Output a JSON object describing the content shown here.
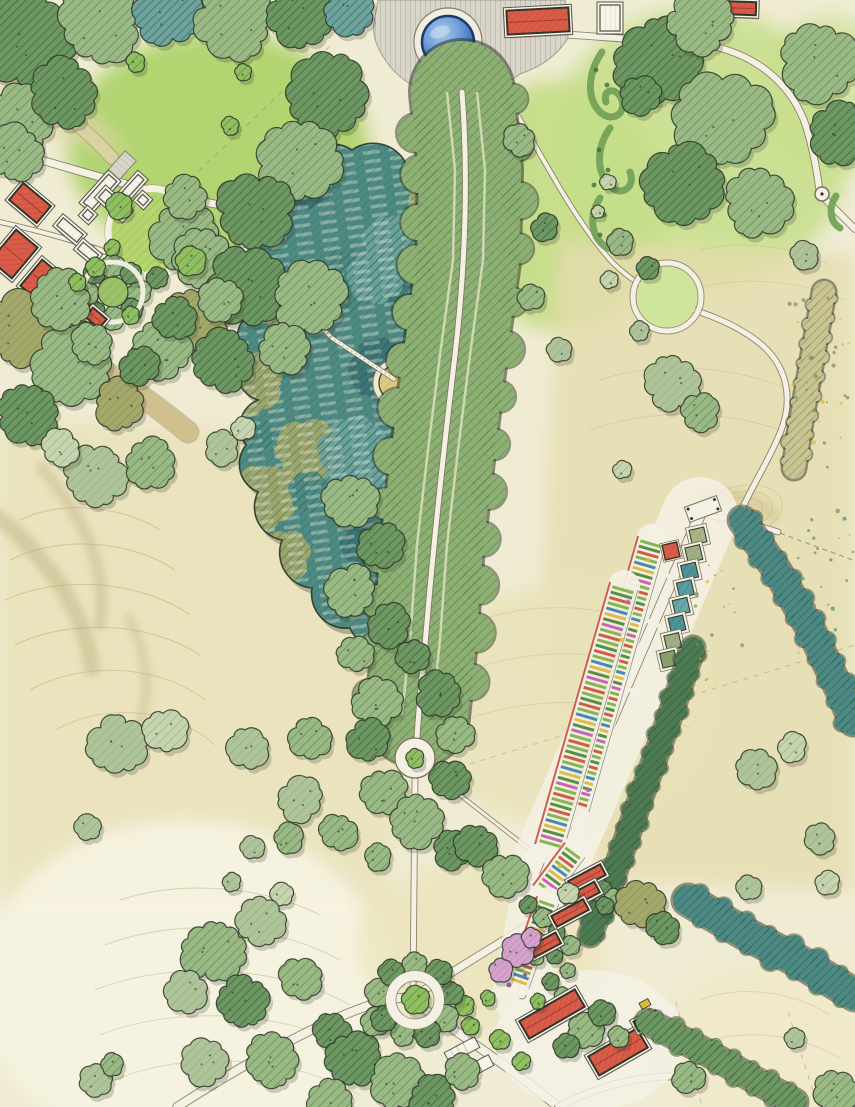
{
  "map": {
    "type": "hand-drawn-watercolor-landscape-masterplan",
    "visible_text": [],
    "palette": {
      "paper": "#f0ecd4",
      "meadow_light": "#e9e2b8",
      "meadow_tan": "#e5dcae",
      "meadow_pale": "#f6f2e0",
      "lawn_bright": "#aed36b",
      "lawn_soft": "#c6de8a",
      "tree_mid": "#9ab985",
      "tree_dark": "#6f9762",
      "tree_sage": "#b0c49c",
      "tree_pale": "#c6d4b0",
      "tree_bright": "#8fbf5e",
      "teal_wood": "#4f8a82",
      "teal_dark": "#3c7272",
      "teal_light": "#6fa39b",
      "olive": "#a3a86b",
      "hatch_green": "#4e7a46",
      "hatch_dark_green": "#2f5c3c",
      "hatch_sage": "#7fa06a",
      "hatch_teal": "#1f5f63",
      "hatch_olive": "#7e7c44",
      "hatch_gray": "#8d887b",
      "hatch_red": "#a93c2a",
      "hatch_pink": "#b76aaa",
      "ink": "#2c3526",
      "road_edge": "#7c725c",
      "road_fill": "#f4f1e4",
      "plaza_gray": "#d9d5c8",
      "roof_red": "#d95c49",
      "pond_deep": "#2a519b",
      "pond_light": "#aac9e9",
      "blossom_pink": "#d4a3cb",
      "contour": "#b4a878",
      "hedge_green": "#4e7a52",
      "allee_green": "#8fb074",
      "glade_floor": "#d9cc82",
      "accent_yellow": "#e0b83c",
      "bed_stripes": [
        "#7fb348",
        "#4e8a3c",
        "#d0543f",
        "#7fb348",
        "#3f85ad",
        "#e0b83c",
        "#4e8a3c",
        "#c75db0",
        "#7fb348",
        "#d0543f"
      ],
      "plot_squares": [
        "#a9b488",
        "#9fae85",
        "#4f9396",
        "#5a9da0",
        "#6aa8a8",
        "#4f9396",
        "#9fae85",
        "#8aa06b"
      ]
    },
    "map_features": [
      {
        "name": "hilltop-terrace-plaza",
        "kind": "hardscape"
      },
      {
        "name": "circular-pond",
        "kind": "water"
      },
      {
        "name": "red-roofed-estate-buildings",
        "kind": "building"
      },
      {
        "name": "scroll-parterre-garden",
        "kind": "planting"
      },
      {
        "name": "woodland-glade-lawn",
        "kind": "lawn"
      },
      {
        "name": "home-farm-cluster",
        "kind": "building"
      },
      {
        "name": "circular-farm-lawn",
        "kind": "lawn"
      },
      {
        "name": "tree-ring-garden",
        "kind": "planting"
      },
      {
        "name": "wet-woodland-grove",
        "kind": "woodland"
      },
      {
        "name": "woodland-clearing",
        "kind": "lawn"
      },
      {
        "name": "boardwalk-path",
        "kind": "circulation"
      },
      {
        "name": "tree-lined-avenue",
        "kind": "woodland"
      },
      {
        "name": "rond-point-with-specimen-tree",
        "kind": "circulation"
      },
      {
        "name": "walled-garden-square-plots",
        "kind": "planting"
      },
      {
        "name": "striped-production-beds",
        "kind": "planting"
      },
      {
        "name": "garden-hedge-windbreak",
        "kind": "planting"
      },
      {
        "name": "orchard-nursery-rows",
        "kind": "planting"
      },
      {
        "name": "glasshouse-frames",
        "kind": "building"
      },
      {
        "name": "farmstead-barns",
        "kind": "building"
      },
      {
        "name": "flowering-blossom-trees",
        "kind": "planting"
      },
      {
        "name": "tree-ring-roundabout",
        "kind": "circulation"
      },
      {
        "name": "hedgerow-stream-corridors",
        "kind": "planting"
      },
      {
        "name": "open-meadow-contours",
        "kind": "landform"
      },
      {
        "name": "winding-estate-paths",
        "kind": "circulation"
      },
      {
        "name": "field-boundary-dashes",
        "kind": "annotation"
      },
      {
        "name": "scattered-parkland-trees",
        "kind": "planting"
      }
    ]
  }
}
